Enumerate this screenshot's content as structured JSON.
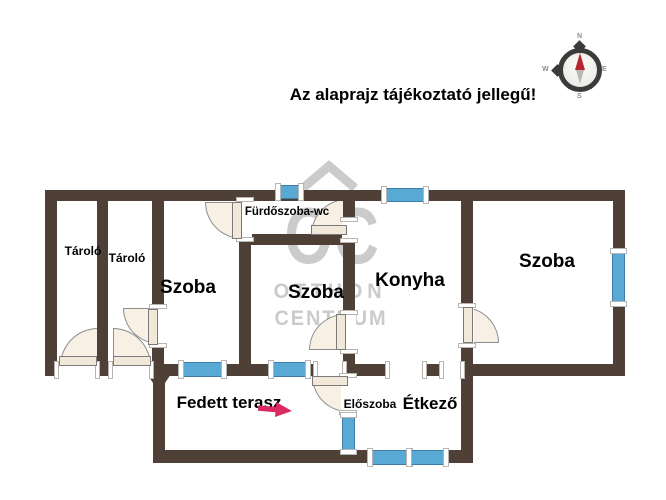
{
  "headline": "Az alaprajz tájékoztató jellegű!",
  "compass": {
    "north": "N",
    "east": "E",
    "south": "S",
    "west": "W"
  },
  "watermark": {
    "logo": "OC",
    "line1": "OTTHON",
    "line2": "CENTRUM"
  },
  "rooms": [
    {
      "id": "tarolo-1",
      "label": "Tároló"
    },
    {
      "id": "tarolo-2",
      "label": "Tároló"
    },
    {
      "id": "szoba-1",
      "label": "Szoba"
    },
    {
      "id": "furdoszoba-wc",
      "label": "Fürdőszoba-wc"
    },
    {
      "id": "szoba-2",
      "label": "Szoba"
    },
    {
      "id": "konyha",
      "label": "Konyha"
    },
    {
      "id": "szoba-3",
      "label": "Szoba"
    },
    {
      "id": "fedett-terasz",
      "label": "Fedett terasz"
    },
    {
      "id": "eloszoba",
      "label": "Előszoba"
    },
    {
      "id": "etkezo",
      "label": "Étkező"
    }
  ],
  "colors": {
    "wall": "#4e4037",
    "window": "#58a9d3",
    "door_fill": "#f8f0e4",
    "watermark": "#cbcbcb",
    "arrow": "#d92a62",
    "compass_needle_north": "#b6252b",
    "compass_needle_south": "#b9b9b6"
  }
}
